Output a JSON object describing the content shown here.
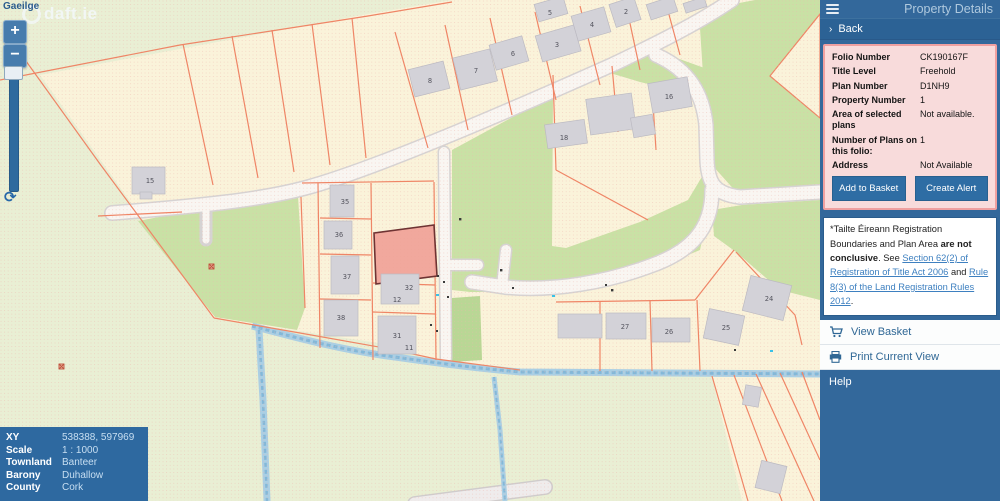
{
  "watermark": "daft.ie",
  "map": {
    "language_link": "Gaeilge",
    "zoom_in": "+",
    "zoom_out": "−",
    "refresh": "⟳",
    "labels": {
      "h15": "15",
      "h35": "35",
      "h36": "36",
      "h37": "37",
      "h38": "38",
      "h32": "32",
      "h12": "12",
      "h31": "31",
      "h11": "11",
      "h8": "8",
      "h7": "7",
      "h6": "6",
      "h5": "5",
      "h4": "4",
      "h3": "3",
      "h2": "2",
      "h18": "18",
      "h16": "16",
      "h27": "27",
      "h26": "26",
      "h25": "25",
      "h24": "24"
    }
  },
  "info_panel": {
    "rows": [
      {
        "label": "XY",
        "value": "538388, 597969"
      },
      {
        "label": "Scale",
        "value": "1 : 1000"
      },
      {
        "label": "Townland",
        "value": "Banteer"
      },
      {
        "label": "Barony",
        "value": "Duhallow"
      },
      {
        "label": "County",
        "value": "Cork"
      }
    ]
  },
  "sidebar": {
    "title": "Property Details",
    "back_chevron": "›",
    "back": "Back",
    "details": {
      "folio_label": "Folio Number",
      "folio": "CK190167F",
      "title_level_label": "Title Level",
      "title_level": "Freehold",
      "plan_label": "Plan Number",
      "plan": "D1NH9",
      "property_label": "Property Number",
      "property": "1",
      "area_label": "Area of selected plans",
      "area": "Not available.",
      "plans_count_label": "Number of Plans on this folio:",
      "plans_count": "1",
      "address_label": "Address",
      "address": "Not Available",
      "add_to_basket": "Add to Basket",
      "create_alert": "Create Alert"
    },
    "disclaimer": {
      "seg1": "*Tailte Éireann Registration Boundaries and Plan Area ",
      "bold": "are not conclusive",
      "seg2": ". See ",
      "link1": "Section 62(2) of Registration of Title Act 2006",
      "seg3": " and ",
      "link2": "Rule 8(3) of the Land Registration Rules 2012",
      "seg4": "."
    },
    "view_basket": "View Basket",
    "print_view": "Print Current View",
    "help": "Help"
  },
  "colors": {
    "sidebar_blue": "#33689b",
    "button_blue": "#2e6da4",
    "panel_pink": "#f8dbdb",
    "panel_pink_border": "#efa0a0",
    "highlight_fill": "#efa096",
    "highlight_stroke": "#6e3333",
    "boundary_orange": "#ef8566",
    "cream": "#faf3da",
    "green": "#c9e1a5",
    "base_green": "#e9efd4",
    "stream_blue": "#aacfe4"
  }
}
